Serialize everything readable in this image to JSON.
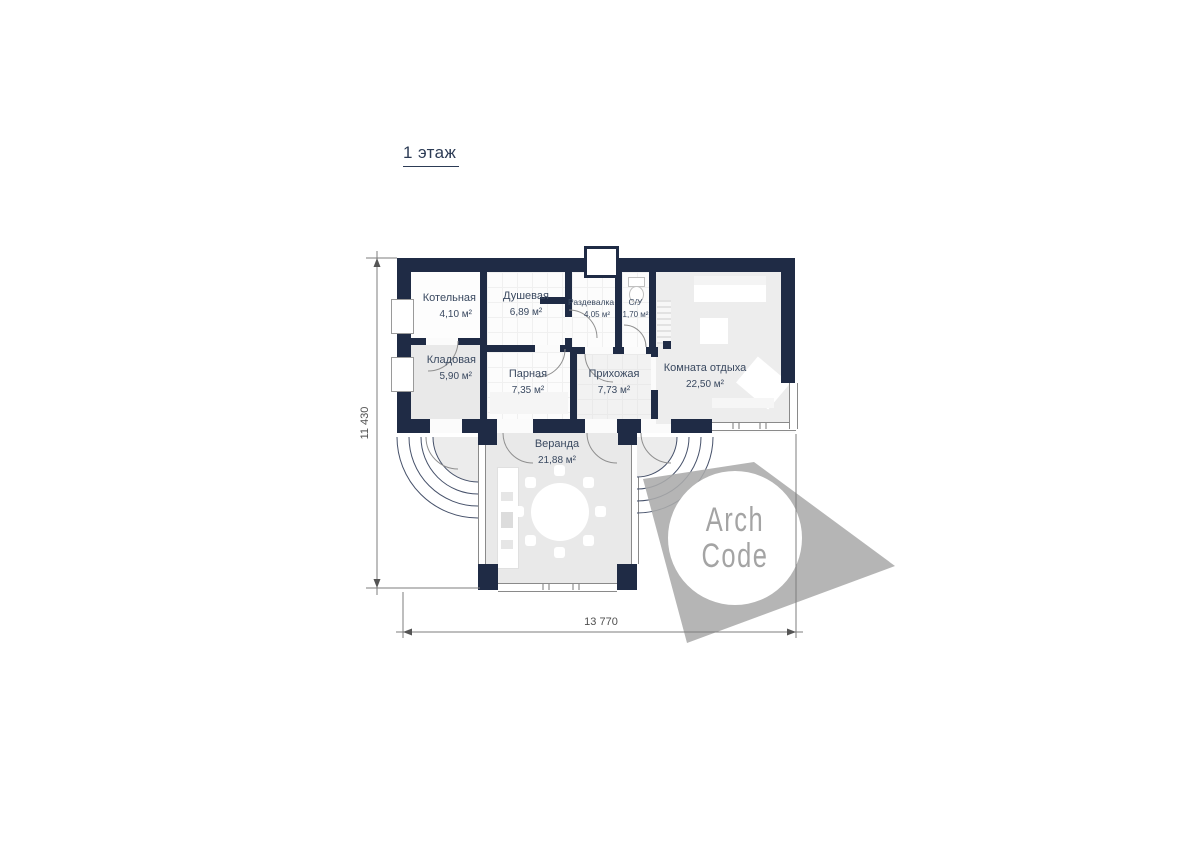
{
  "title": "1 этаж",
  "rooms": [
    {
      "name": "Котельная",
      "area": "4,10 м²"
    },
    {
      "name": "Душевая",
      "area": "6,89 м²"
    },
    {
      "name": "Раздевалка",
      "area": "4,05 м²"
    },
    {
      "name": "С/У",
      "area": "1,70 м²"
    },
    {
      "name": "Кладовая",
      "area": "5,90 м²"
    },
    {
      "name": "Парная",
      "area": "7,35 м²"
    },
    {
      "name": "Прихожая",
      "area": "7,73 м²"
    },
    {
      "name": "Комната отдыха",
      "area": "22,50 м²"
    },
    {
      "name": "Веранда",
      "area": "21,88 м²"
    }
  ],
  "dimensions": {
    "width": "13 770",
    "height": "11 430"
  },
  "logo": {
    "line1": "Arch",
    "line2": "Code"
  },
  "colors": {
    "wall": "#1f2b45",
    "label_text": "#3a4960",
    "dimension_text": "#4f4f4f",
    "logo_gray": "#ababab",
    "accent_dashed": "#f2a472"
  }
}
